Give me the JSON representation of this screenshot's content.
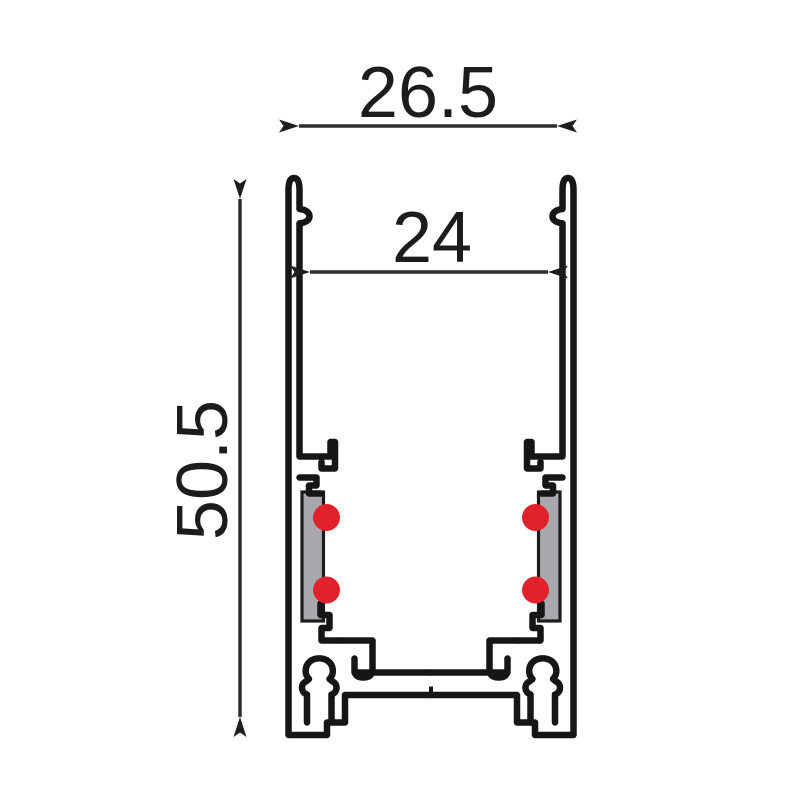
{
  "diagram": {
    "type": "technical-cross-section",
    "subject": "aluminium-track-profile",
    "dimensions": {
      "outer_width": {
        "value": "26.5",
        "orientation": "horizontal"
      },
      "inner_width": {
        "value": "24",
        "orientation": "horizontal"
      },
      "height": {
        "value": "50.5",
        "orientation": "vertical"
      }
    },
    "colors": {
      "line": "#161616",
      "dimension_line": "#2e2e2e",
      "conductor_red": "#e2222b",
      "insulator_gray": "#a9a8ad",
      "background": "#ffffff"
    },
    "features": {
      "conductor_contacts_count": 4,
      "insulator_strips_count": 2
    }
  }
}
